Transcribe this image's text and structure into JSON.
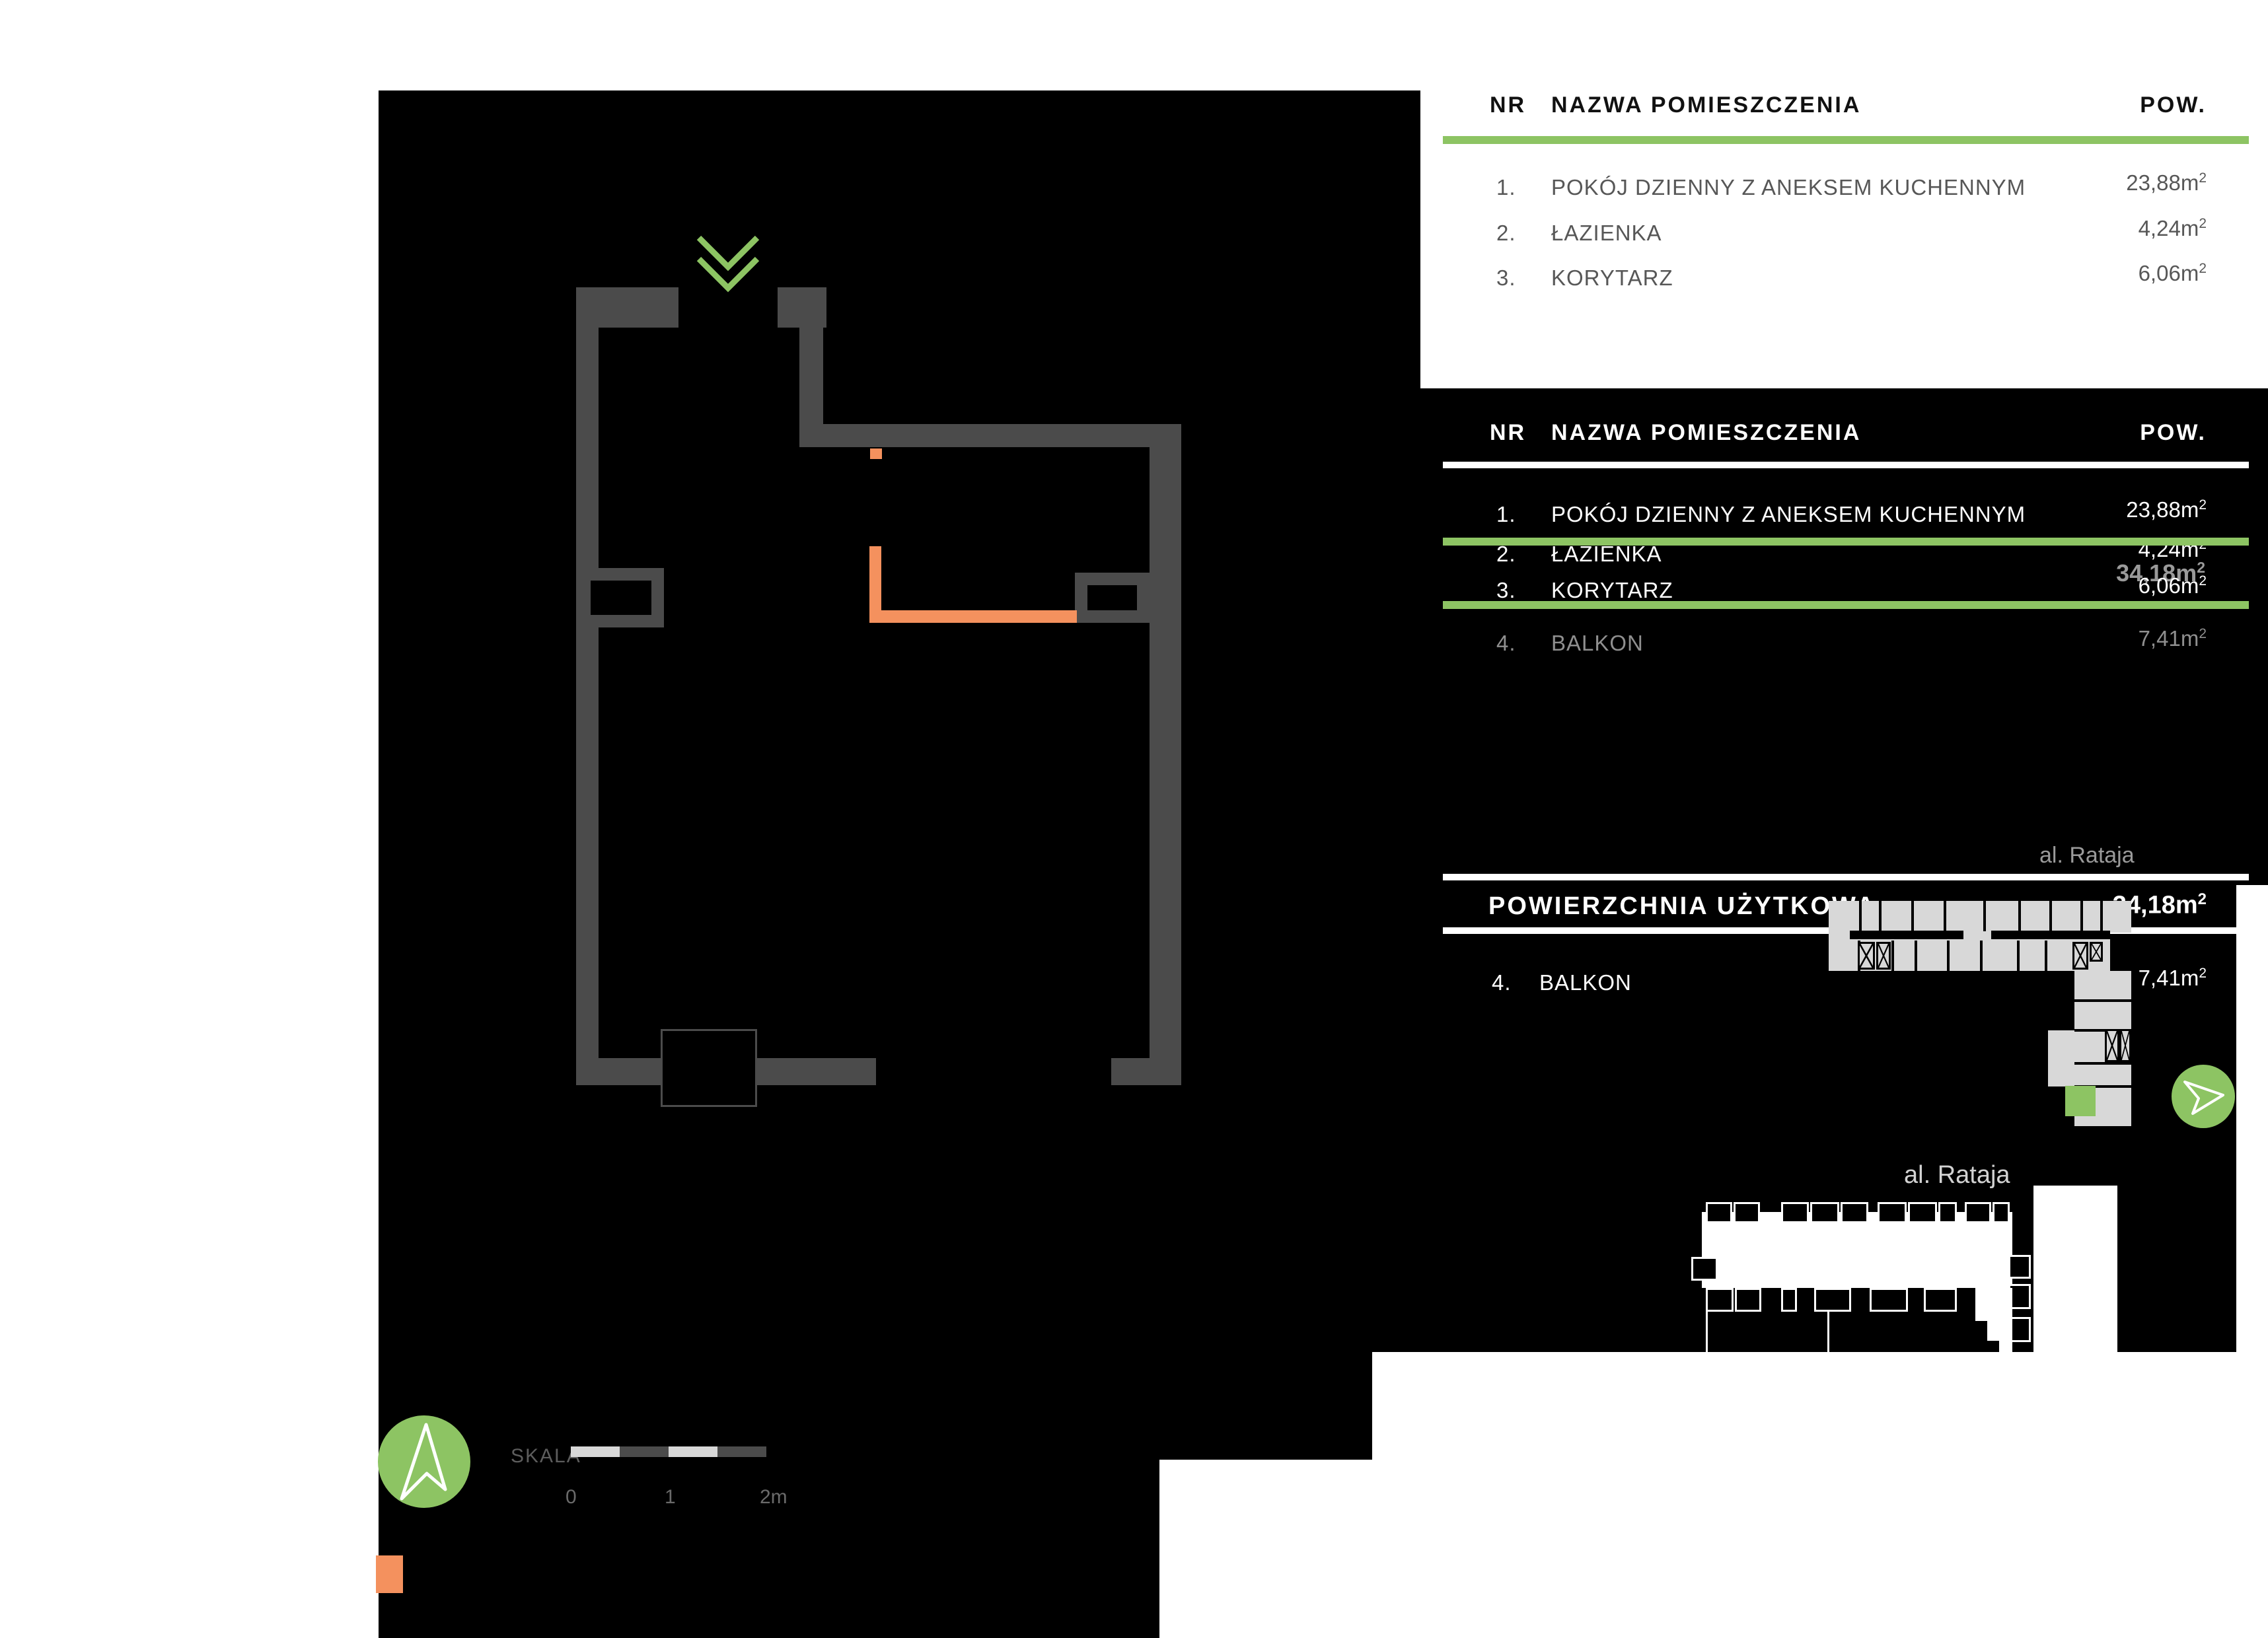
{
  "colors": {
    "accent_green": "#8dc463",
    "accent_orange": "#f4915e",
    "wall_gray": "#4b4b4b",
    "building_gray": "#d8d8d8"
  },
  "room_table": {
    "headers": {
      "nr": "NR",
      "name": "NAZWA POMIESZCZENIA",
      "pow": "POW."
    },
    "rows": [
      {
        "no": "1.",
        "name": "POKÓJ DZIENNY Z ANEKSEM KUCHENNYM",
        "area": "23,88"
      },
      {
        "no": "2.",
        "name": "ŁAZIENKA",
        "area": "4,24"
      },
      {
        "no": "3.",
        "name": "KORYTARZ",
        "area": "6,06"
      }
    ],
    "balcony_row": {
      "no": "4.",
      "name": "BALKON",
      "area": "7,41"
    },
    "total_area": "34,18",
    "unit_base": "m",
    "unit_sup": "2"
  },
  "summary": {
    "label": "POWIERZCHNIA UŻYTKOWA",
    "value": "34,18"
  },
  "street_label": "al. Rataja",
  "scale_bar": {
    "label": "SKALA",
    "tick0": "0",
    "tick1": "1",
    "tick2": "2m"
  },
  "icons": {
    "entrance_chevron": "double-chevron-down",
    "north_arrow": "north-arrow",
    "direction_arrow": "paper-plane-right",
    "stairs_marker": "x-cross-box"
  }
}
